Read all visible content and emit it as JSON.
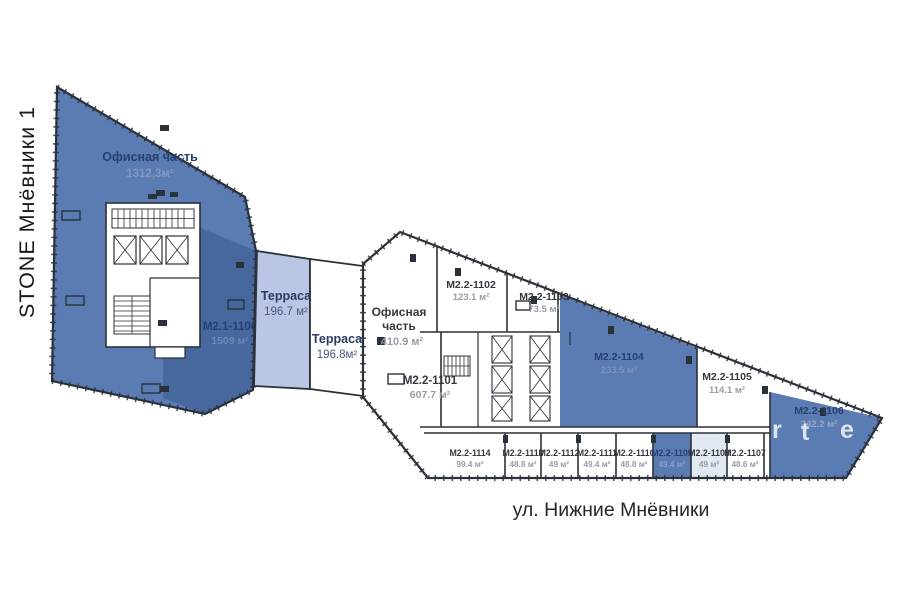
{
  "title": {
    "building": "STONE Мнёвники 1",
    "street": "ул. Нижние Мнёвники"
  },
  "colors": {
    "unit_blue": "#5b7bb3",
    "unit_blue_dark": "#47689f",
    "terrace_blue": "#b9c7e5",
    "unit_pale_blue": "#e3e9f3",
    "wall": "#2b3139"
  },
  "left_building": {
    "office": {
      "label": "Офисная часть",
      "area": "1312,3м²"
    },
    "unit": {
      "label": "M2.1-1100",
      "area": "1509 м²"
    }
  },
  "terraces": [
    {
      "label": "Терраса",
      "area": "196.7 м²"
    },
    {
      "label": "Терраса",
      "area": "196.8м²"
    }
  ],
  "right_building": {
    "office": {
      "label_line1": "Офисная",
      "label_line2": "часть",
      "area": "410.9 м²"
    }
  },
  "units": {
    "u1101": {
      "label": "M2.2-1101",
      "area": "607.7 м²"
    },
    "u1102": {
      "label": "M2.2-1102",
      "area": "123.1 м²"
    },
    "u1103": {
      "label": "M2.2-1103",
      "area": "73.5 м²"
    },
    "u1104": {
      "label": "M2.2-1104",
      "area": "233.5 м²"
    },
    "u1105": {
      "label": "M2.2-1105",
      "area": "114.1 м²"
    },
    "u1106": {
      "label": "M2.2-1106",
      "area": "242.2 м²"
    },
    "u1107": {
      "label": "M2.2-1107",
      "area": "48.6 м²"
    },
    "u1108": {
      "label": "M2.2-1108",
      "area": "49 м²"
    },
    "u1109": {
      "label": "M2.2-1109",
      "area": "49.4 м²"
    },
    "u1110": {
      "label": "M2.2-1110",
      "area": "48.8 м²"
    },
    "u1111": {
      "label": "M2.2-1111",
      "area": "49.4 м²"
    },
    "u1112": {
      "label": "M2.2-1112",
      "area": "49 м²"
    },
    "u1113": {
      "label": "M2.2-1113",
      "area": "48.8 м²"
    },
    "u1114": {
      "label": "M2.2-1114",
      "area": "99.4 м²"
    }
  },
  "watermark": {
    "letters": [
      "r",
      "t",
      "e"
    ]
  }
}
